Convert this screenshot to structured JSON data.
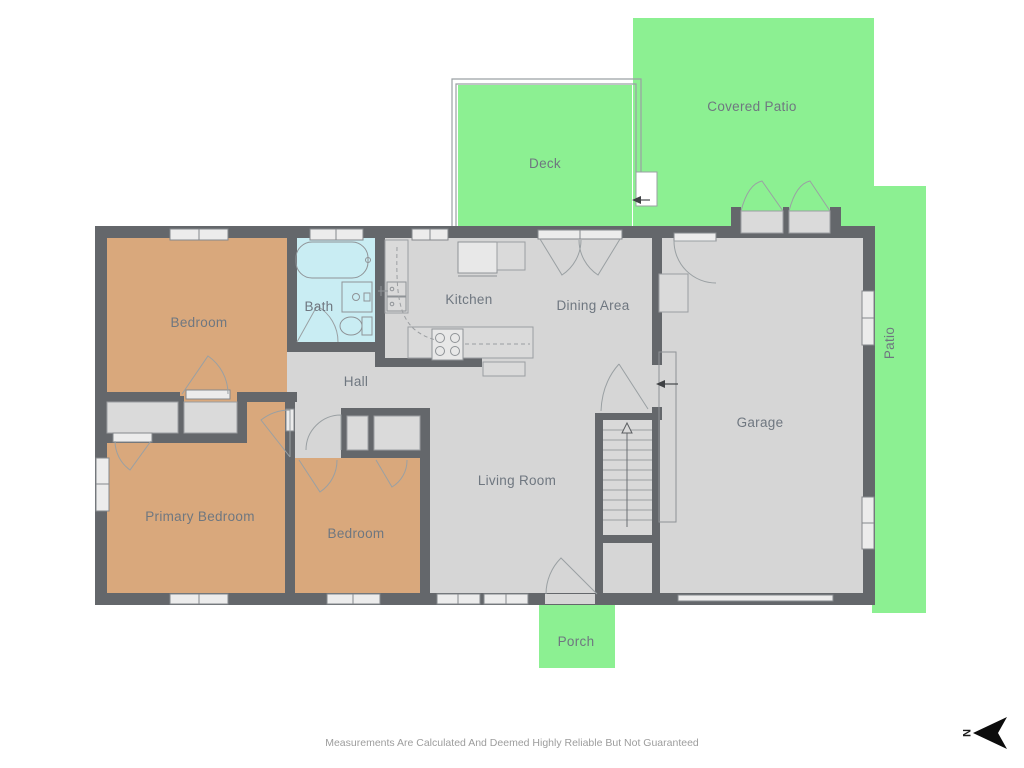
{
  "page": {
    "background": "#ffffff"
  },
  "palette": {
    "wall": "#64676b",
    "floor": "#d6d6d6",
    "bedroom_tan": "#d9a87c",
    "bath_blue": "#c9edf3",
    "outdoor_green": "#8cf092",
    "closet_gray": "#dadada",
    "window_fill": "#ececec",
    "thin_line": "#8f9397",
    "label_text": "#6f7780",
    "disclaimer_text": "#9d9d9d",
    "north_arrow": "#0c0c0c"
  },
  "rooms": {
    "bedroom_tl": {
      "label": "Bedroom"
    },
    "bath": {
      "label": "Bath"
    },
    "kitchen": {
      "label": "Kitchen"
    },
    "dining": {
      "label": "Dining Area"
    },
    "hall": {
      "label": "Hall"
    },
    "living": {
      "label": "Living Room"
    },
    "garage": {
      "label": "Garage"
    },
    "primary_bedroom": {
      "label": "Primary Bedroom"
    },
    "bedroom_m": {
      "label": "Bedroom"
    },
    "deck": {
      "label": "Deck"
    },
    "covered_patio": {
      "label": "Covered Patio"
    },
    "patio": {
      "label": "Patio"
    },
    "porch": {
      "label": "Porch"
    }
  },
  "footer": {
    "disclaimer": "Measurements Are Calculated And Deemed Highly Reliable But Not Guaranteed"
  },
  "compass": {
    "north_label": "N"
  }
}
